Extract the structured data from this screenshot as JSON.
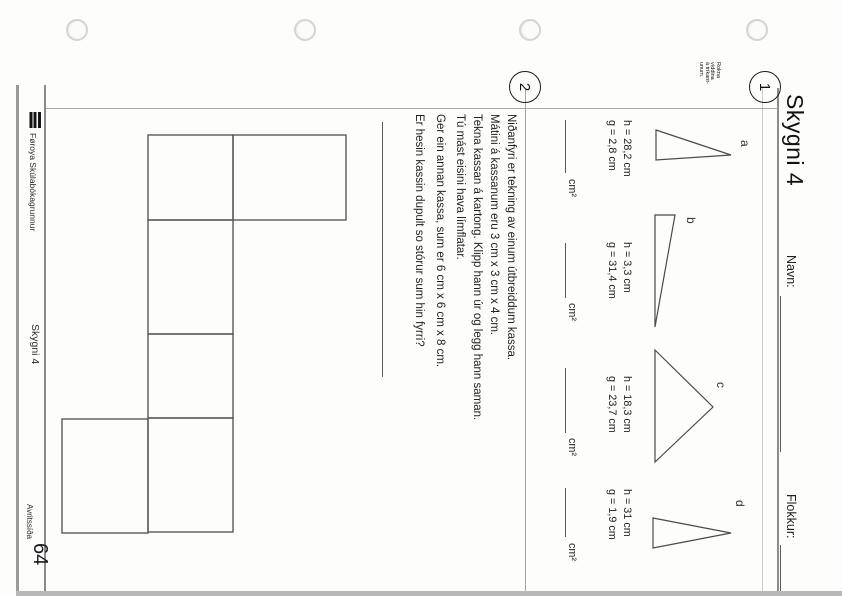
{
  "header": {
    "title": "Skygni 4",
    "name_label": "Navn:",
    "class_label": "Flokkur:"
  },
  "section1": {
    "number": "1",
    "margin_note": "Rokna\nvíddina\ná tríkant-\nunum.",
    "unit": "cm²",
    "triangles": [
      {
        "label": "a",
        "h": "h = 28,2 cm",
        "g": "g = 2,8 cm"
      },
      {
        "label": "b",
        "h": "h = 3,3 cm",
        "g": "g = 31,4 cm"
      },
      {
        "label": "c",
        "h": "h = 18,3 cm",
        "g": "g = 23,7 cm"
      },
      {
        "label": "d",
        "h": "h = 31 cm",
        "g": "g = 1,9 cm"
      }
    ]
  },
  "section2": {
    "number": "2",
    "lines": [
      "Niðanfyri er tekning av einum útbreiddum kassa.",
      "Mátini á kassanum eru 3 cm x 3 cm x 4 cm.",
      "Tekna kassan á kartong. Klipp hann úr og legg hann saman.",
      "Tú mást eisini hava límflatar.",
      "Ger ein annan kassa, sum er 6 cm x 6 cm x 8 cm.",
      "Er hesin kassin dupult so stórur sum hin fyrri?"
    ]
  },
  "footer": {
    "publisher": "Føroya Skúlabókagrunnur",
    "series": "Skygni 4",
    "page_label": "Avritssíða",
    "page_number": "64"
  },
  "colors": {
    "ink": "#1c1c1c",
    "rule_gray": "#8c8c8c",
    "paper": "#fdfdfc"
  }
}
